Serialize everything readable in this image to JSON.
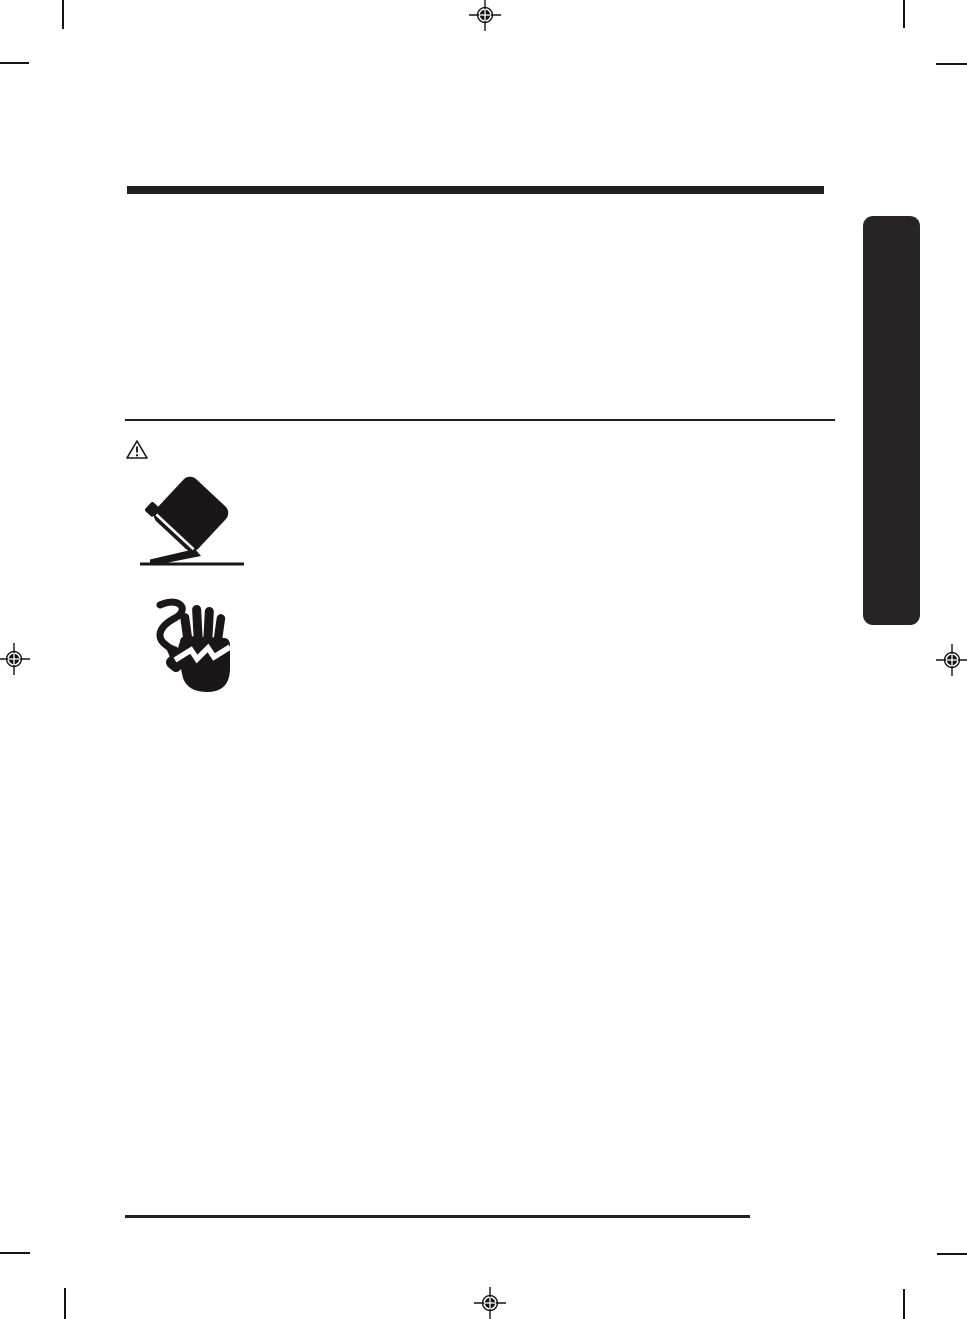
{
  "page": {
    "background": "#ffffff",
    "ink_color": "#231f20"
  },
  "header": {
    "bar_color": "#231f20"
  },
  "safety": {
    "alert_icon": "warning-triangle-icon",
    "hazard_icons": [
      {
        "name": "appliance-tip-over-icon"
      },
      {
        "name": "electric-shock-hand-icon"
      }
    ]
  },
  "side_tab": {
    "color": "#282425",
    "label": ""
  },
  "footer": {
    "rule_color": "#231f20"
  },
  "print_marks": {
    "color": "#141414",
    "registration_targets": [
      "top-center",
      "left-middle",
      "right-middle",
      "bottom-center"
    ],
    "corner_crop_marks": [
      "top-left",
      "top-right",
      "bottom-left",
      "bottom-right"
    ]
  }
}
